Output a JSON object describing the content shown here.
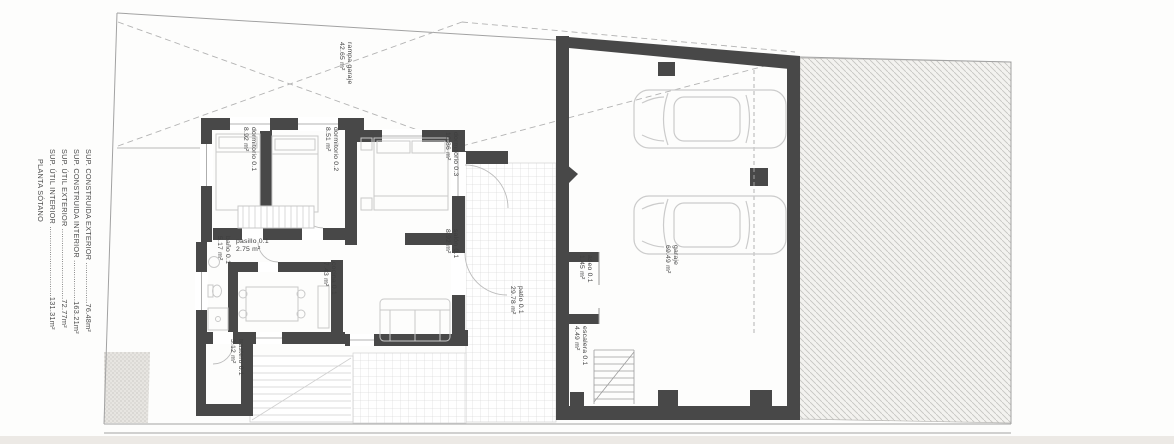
{
  "title_block": {
    "lines": [
      "PLANTA SÓTANO",
      "SUP. ÚTIL INTERIOR ...............................131.31m²",
      "SUP. ÚTIL EXTERIOR ...............................72.77m²",
      "SUP. CONSTRUIDA INTERIOR ..................163.21m²",
      "SUP. CONSTRUIDA EXTERIOR ..................76.48m²"
    ]
  },
  "rooms": [
    {
      "name": "rampa garaje",
      "area": "42.65 m²"
    },
    {
      "name": "dormitorio 0.1",
      "area": "8.92 m²"
    },
    {
      "name": "dormitorio 0.2",
      "area": "8.51 m²"
    },
    {
      "name": "dormitorio 0.3",
      "area": "10.86 m²"
    },
    {
      "name": "pasillo 0.1",
      "area": "2.75 m²"
    },
    {
      "name": "baño 0.1",
      "area": "5.17 m²"
    },
    {
      "name": "cocina 0.1",
      "area": "7.43 m²"
    },
    {
      "name": "salón 0.1",
      "area": "8.92 m²"
    },
    {
      "name": "trastero 0.1",
      "area": "3.12 m²"
    },
    {
      "name": "patio 0.1",
      "area": "29.78 m²"
    },
    {
      "name": "aseo 0.1",
      "area": "1.45 m²"
    },
    {
      "name": "escalera 0.1",
      "area": "4.49 m²"
    },
    {
      "name": "garaje",
      "area": "69.49 m²"
    }
  ],
  "colors": {
    "wall": "#484848",
    "boundary_line": "#a2a2a2",
    "furniture_line": "#c9c9c9",
    "tile_line": "#dbdbdb",
    "hatch_line": "#c5c4c1",
    "label_text": "#3e3e3e"
  }
}
